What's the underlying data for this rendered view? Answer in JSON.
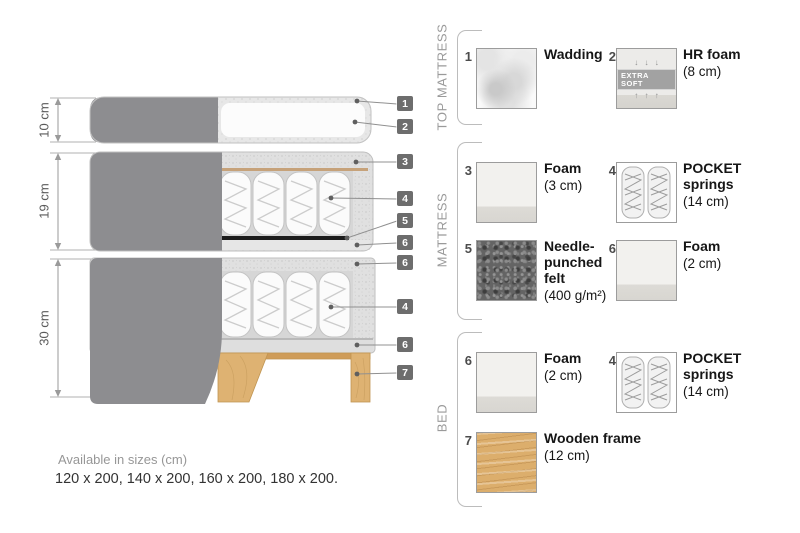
{
  "footer": {
    "line1": "Available in sizes (cm)",
    "line2": "120 x 200, 140 x 200, 160 x 200, 180 x 200."
  },
  "diagram": {
    "dimensions": [
      {
        "label": "10 cm"
      },
      {
        "label": "19 cm"
      },
      {
        "label": "30 cm"
      }
    ],
    "callouts": [
      {
        "num": "1"
      },
      {
        "num": "2"
      },
      {
        "num": "3"
      },
      {
        "num": "4"
      },
      {
        "num": "5"
      },
      {
        "num": "6"
      },
      {
        "num": "6"
      },
      {
        "num": "4"
      },
      {
        "num": "6"
      },
      {
        "num": "7"
      }
    ]
  },
  "legend": {
    "sections": [
      {
        "label": "TOP MATTRESS",
        "items": [
          {
            "num": "1",
            "name": "Wadding",
            "detail": ""
          },
          {
            "num": "2",
            "name": "HR foam",
            "detail": "(8 cm)",
            "badge": "EXTRA SOFT",
            "arrows_top": "↓ ↓ ↓",
            "arrows_bottom": "↑ ↑ ↑"
          }
        ]
      },
      {
        "label": "MATTRESS",
        "items": [
          {
            "num": "3",
            "name": "Foam",
            "detail": "(3 cm)"
          },
          {
            "num": "4",
            "name": "POCKET springs",
            "detail": "(14 cm)"
          },
          {
            "num": "5",
            "name": "Needle-punched felt",
            "detail": "(400 g/m²)"
          },
          {
            "num": "6",
            "name": "Foam",
            "detail": "(2 cm)"
          }
        ]
      },
      {
        "label": "BED",
        "items": [
          {
            "num": "6",
            "name": "Foam",
            "detail": "(2 cm)"
          },
          {
            "num": "4",
            "name": "POCKET springs",
            "detail": "(14 cm)"
          },
          {
            "num": "7",
            "name": "Wooden frame",
            "detail": "(12 cm)"
          }
        ]
      }
    ]
  },
  "colors": {
    "fabric_gray": "#8d8d90",
    "wood_tan": "#deb272",
    "callout_chip": "#6d6d6d",
    "felt_black": "#1c1c1c"
  }
}
